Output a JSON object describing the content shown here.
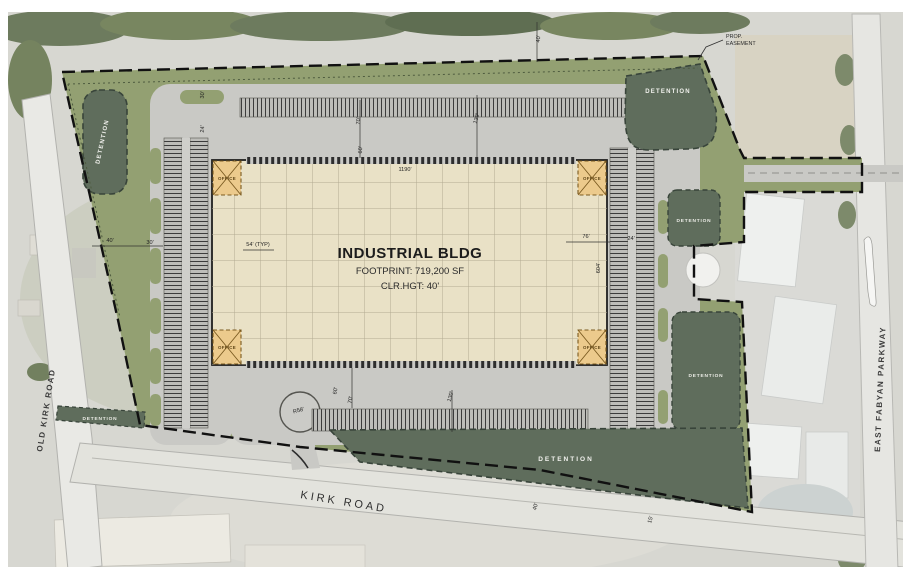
{
  "building": {
    "name": "INDUSTRIAL BLDG",
    "footprint": "FOOTPRINT: 719,200 SF",
    "clear_height": "CLR.HGT: 40'",
    "office_label": "OFFICE"
  },
  "roads": {
    "old_kirk_road": "OLD KIRK ROAD",
    "kirk_road": "KIRK ROAD",
    "east_fabyan_parkway": "EAST FABYAN PARKWAY"
  },
  "annotations": {
    "prop_easement_line1": "PROP.",
    "prop_easement_line2": "EASEMENT"
  },
  "detention_basins": [
    {
      "id": "northwest",
      "label": "DETENTION"
    },
    {
      "id": "northeast",
      "label": "DETENTION"
    },
    {
      "id": "east-upper",
      "label": "DETENTION"
    },
    {
      "id": "east-lower",
      "label": "DETENTION"
    },
    {
      "id": "south",
      "label": "DETENTION"
    },
    {
      "id": "southwest",
      "label": "DETENTION"
    }
  ],
  "dimensions": [
    {
      "text": "1190'",
      "x": 405,
      "y": 171,
      "rot": 0
    },
    {
      "text": "54' (TYP)",
      "x": 258,
      "y": 246,
      "rot": 0
    },
    {
      "text": "76'",
      "x": 586,
      "y": 238,
      "rot": 0
    },
    {
      "text": "24'",
      "x": 631,
      "y": 240,
      "rot": 0
    },
    {
      "text": "604'",
      "x": 600,
      "y": 268,
      "rot": -90
    },
    {
      "text": "70'",
      "x": 360,
      "y": 121,
      "rot": -87
    },
    {
      "text": "130'",
      "x": 478,
      "y": 119,
      "rot": -75
    },
    {
      "text": "60'",
      "x": 362,
      "y": 150,
      "rot": -87
    },
    {
      "text": "60'",
      "x": 337,
      "y": 391,
      "rot": -80
    },
    {
      "text": "70'",
      "x": 352,
      "y": 400,
      "rot": -80
    },
    {
      "text": "130'",
      "x": 452,
      "y": 397,
      "rot": -75
    },
    {
      "text": "40'",
      "x": 110,
      "y": 242,
      "rot": 0
    },
    {
      "text": "30'",
      "x": 150,
      "y": 244,
      "rot": 0
    },
    {
      "text": "40'",
      "x": 537,
      "y": 507,
      "rot": -75
    },
    {
      "text": "15'",
      "x": 652,
      "y": 520,
      "rot": -75
    },
    {
      "text": "40'",
      "x": 540,
      "y": 39,
      "rot": -87
    },
    {
      "text": "30'",
      "x": 204,
      "y": 95,
      "rot": -87
    },
    {
      "text": "24'",
      "x": 204,
      "y": 129,
      "rot": -87
    },
    {
      "text": "R58'",
      "x": 299,
      "y": 412,
      "rot": -15
    }
  ],
  "colors": {
    "site_green": "#93a072",
    "pavement": "#c9c9c5",
    "building_fill": "#e9e1c6",
    "building_grid": "#b3ab92",
    "office_fill": "#ecca8c",
    "detention_fill": "#5f6d5c",
    "boundary": "#111111",
    "aerial_base": "#d7d7d1"
  }
}
